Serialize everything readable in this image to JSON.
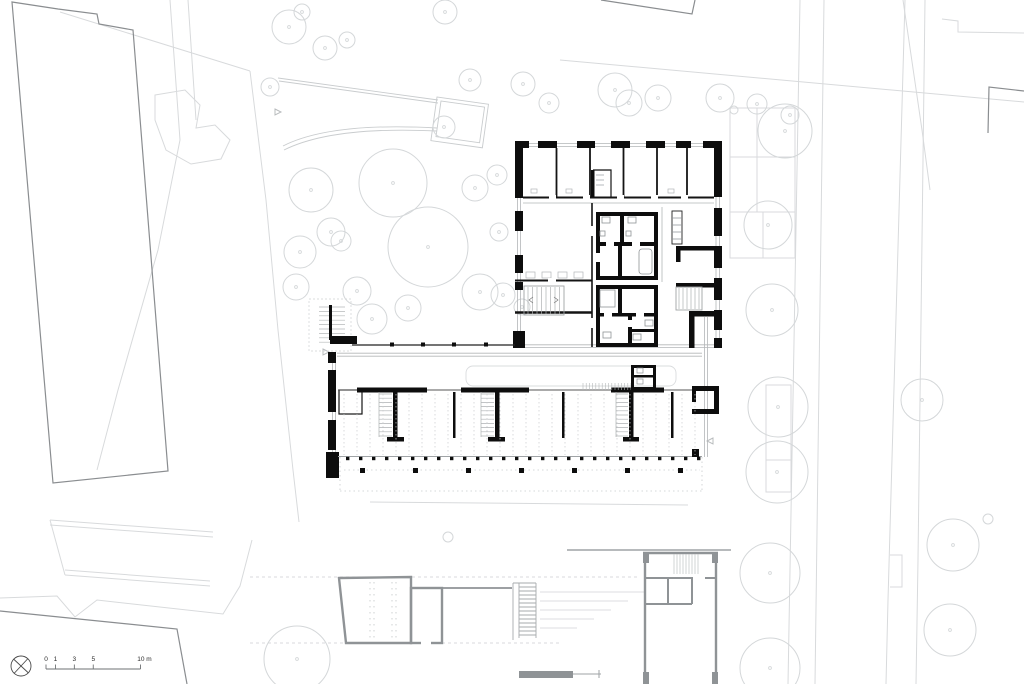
{
  "meta": {
    "drawing_type": "architectural ground-floor site plan",
    "sheet_background": "#ffffff"
  },
  "palette": {
    "wall_black": "#0d0d0d",
    "line_dark": "#1a1a1a",
    "line_mid": "#9fa3a6",
    "line_pale": "#d7d9db",
    "tree_pale": "#d4d7d9",
    "neighbor_gray": "#8a8d90",
    "secondary_gray": "#8f9396",
    "hatch_gray": "#bfc2c4"
  },
  "scale_bar": {
    "x0": 46,
    "y_bar": 669,
    "px_per_m": 9.45,
    "labels": [
      {
        "text": "0",
        "m": 0
      },
      {
        "text": "1",
        "m": 1
      },
      {
        "text": "3",
        "m": 3
      },
      {
        "text": "5",
        "m": 5
      },
      {
        "text": "10 m",
        "m": 10
      }
    ]
  },
  "compass": {
    "icon": "north-orientation-symbol",
    "cx": 21,
    "cy": 666,
    "r": 10
  },
  "trees": [
    [
      289,
      27,
      17
    ],
    [
      325,
      48,
      12
    ],
    [
      347,
      40,
      8
    ],
    [
      302,
      12,
      8
    ],
    [
      270,
      87,
      9
    ],
    [
      445,
      12,
      12
    ],
    [
      470,
      80,
      11
    ],
    [
      523,
      84,
      12
    ],
    [
      549,
      103,
      10
    ],
    [
      615,
      90,
      17
    ],
    [
      629,
      103,
      13
    ],
    [
      658,
      98,
      13
    ],
    [
      720,
      98,
      14
    ],
    [
      757,
      104,
      10
    ],
    [
      790,
      115,
      9
    ],
    [
      734,
      110,
      4
    ],
    [
      785,
      131,
      27
    ],
    [
      393,
      183,
      34
    ],
    [
      428,
      247,
      40
    ],
    [
      311,
      190,
      22
    ],
    [
      331,
      232,
      14
    ],
    [
      300,
      252,
      16
    ],
    [
      296,
      287,
      13
    ],
    [
      357,
      291,
      14
    ],
    [
      341,
      241,
      10
    ],
    [
      372,
      319,
      15
    ],
    [
      408,
      308,
      13
    ],
    [
      480,
      292,
      18
    ],
    [
      475,
      188,
      13
    ],
    [
      444,
      127,
      11
    ],
    [
      497,
      175,
      10
    ],
    [
      499,
      232,
      9
    ],
    [
      503,
      295,
      12
    ],
    [
      522,
      307,
      8
    ],
    [
      768,
      225,
      24
    ],
    [
      772,
      310,
      26
    ],
    [
      778,
      407,
      30
    ],
    [
      777,
      472,
      31
    ],
    [
      770,
      573,
      30
    ],
    [
      770,
      668,
      30
    ],
    [
      922,
      400,
      21
    ],
    [
      953,
      545,
      26
    ],
    [
      950,
      630,
      26
    ],
    [
      988,
      519,
      5
    ],
    [
      297,
      659,
      33
    ],
    [
      448,
      537,
      5
    ]
  ],
  "deck": {
    "dash": {
      "count": 28,
      "x0": 344,
      "step": 13,
      "y1": 394,
      "y2": 455
    },
    "col_row1": {
      "count": 28,
      "x0": 346,
      "step": 13,
      "y": 456.8,
      "size": 3.4
    },
    "col_row2": {
      "count": 7,
      "x0": 360,
      "step": 53,
      "y": 468,
      "size": 5
    },
    "colonnade_cols": {
      "xs": [
        390,
        421,
        452,
        484
      ],
      "y": 342.5,
      "size": 4
    }
  }
}
